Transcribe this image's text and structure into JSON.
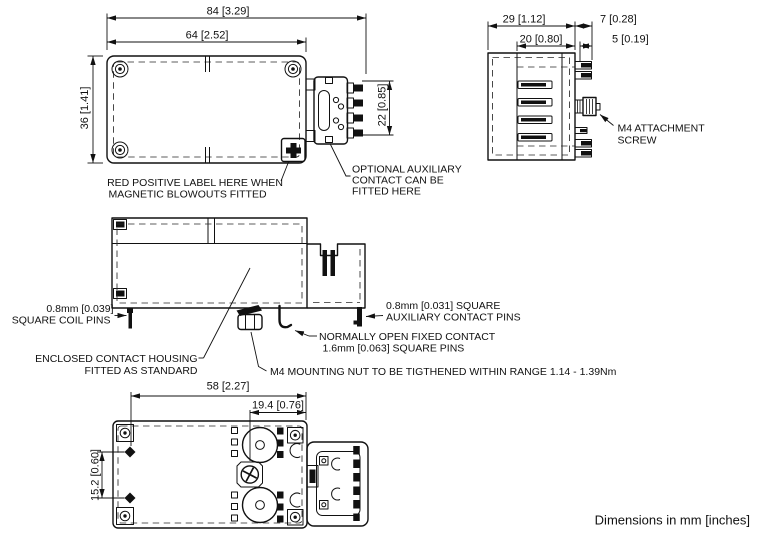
{
  "colors": {
    "ink": "#111111",
    "background": "#ffffff"
  },
  "note": "Dimensions in mm [inches]",
  "plan_view": {
    "dim_total_width": "84 [3.29]",
    "dim_body_width": "64 [2.52]",
    "dim_height": "36 [1.41]",
    "dim_aux_contact_height": "22 [0.85]",
    "label_red_positive_line1": "RED POSITIVE LABEL HERE WHEN",
    "label_red_positive_line2": "MAGNETIC BLOWOUTS FITTED",
    "label_optional_aux_line1": "OPTIONAL AUXILIARY",
    "label_optional_aux_line2": "CONTACT CAN BE",
    "label_optional_aux_line3": "FITTED HERE"
  },
  "side_view": {
    "dim_total_depth": "29 [1.12]",
    "dim_pin_depth": "7 [0.28]",
    "dim_body_depth": "20 [0.80]",
    "dim_aux_pin_depth": "5 [0.19]",
    "label_screw_line1": "M4 ATTACHMENT",
    "label_screw_line2": "SCREW"
  },
  "front_view": {
    "label_coil_pins_line1": "0.8mm [0.039]",
    "label_coil_pins_line2": "SQUARE COIL PINS",
    "label_housing_line1": "ENCLOSED CONTACT HOUSING",
    "label_housing_line2": "FITTED AS STANDARD",
    "label_mounting_nut": "M4 MOUNTING NUT TO BE TIGTHENED WITHIN RANGE 1.14 - 1.39Nm",
    "label_fixed_contact_line1": "NORMALLY OPEN FIXED CONTACT",
    "label_fixed_contact_line2": "1.6mm [0.063] SQUARE PINS",
    "label_aux_pins_line1": "0.8mm [0.031] SQUARE",
    "label_aux_pins_line2": "AUXILIARY CONTACT PINS"
  },
  "bottom_view": {
    "dim_mount_width": "58 [2.27]",
    "dim_screw_offset": "19.4 [0.76]",
    "dim_hole_pitch": "15.2 [0.60]"
  }
}
